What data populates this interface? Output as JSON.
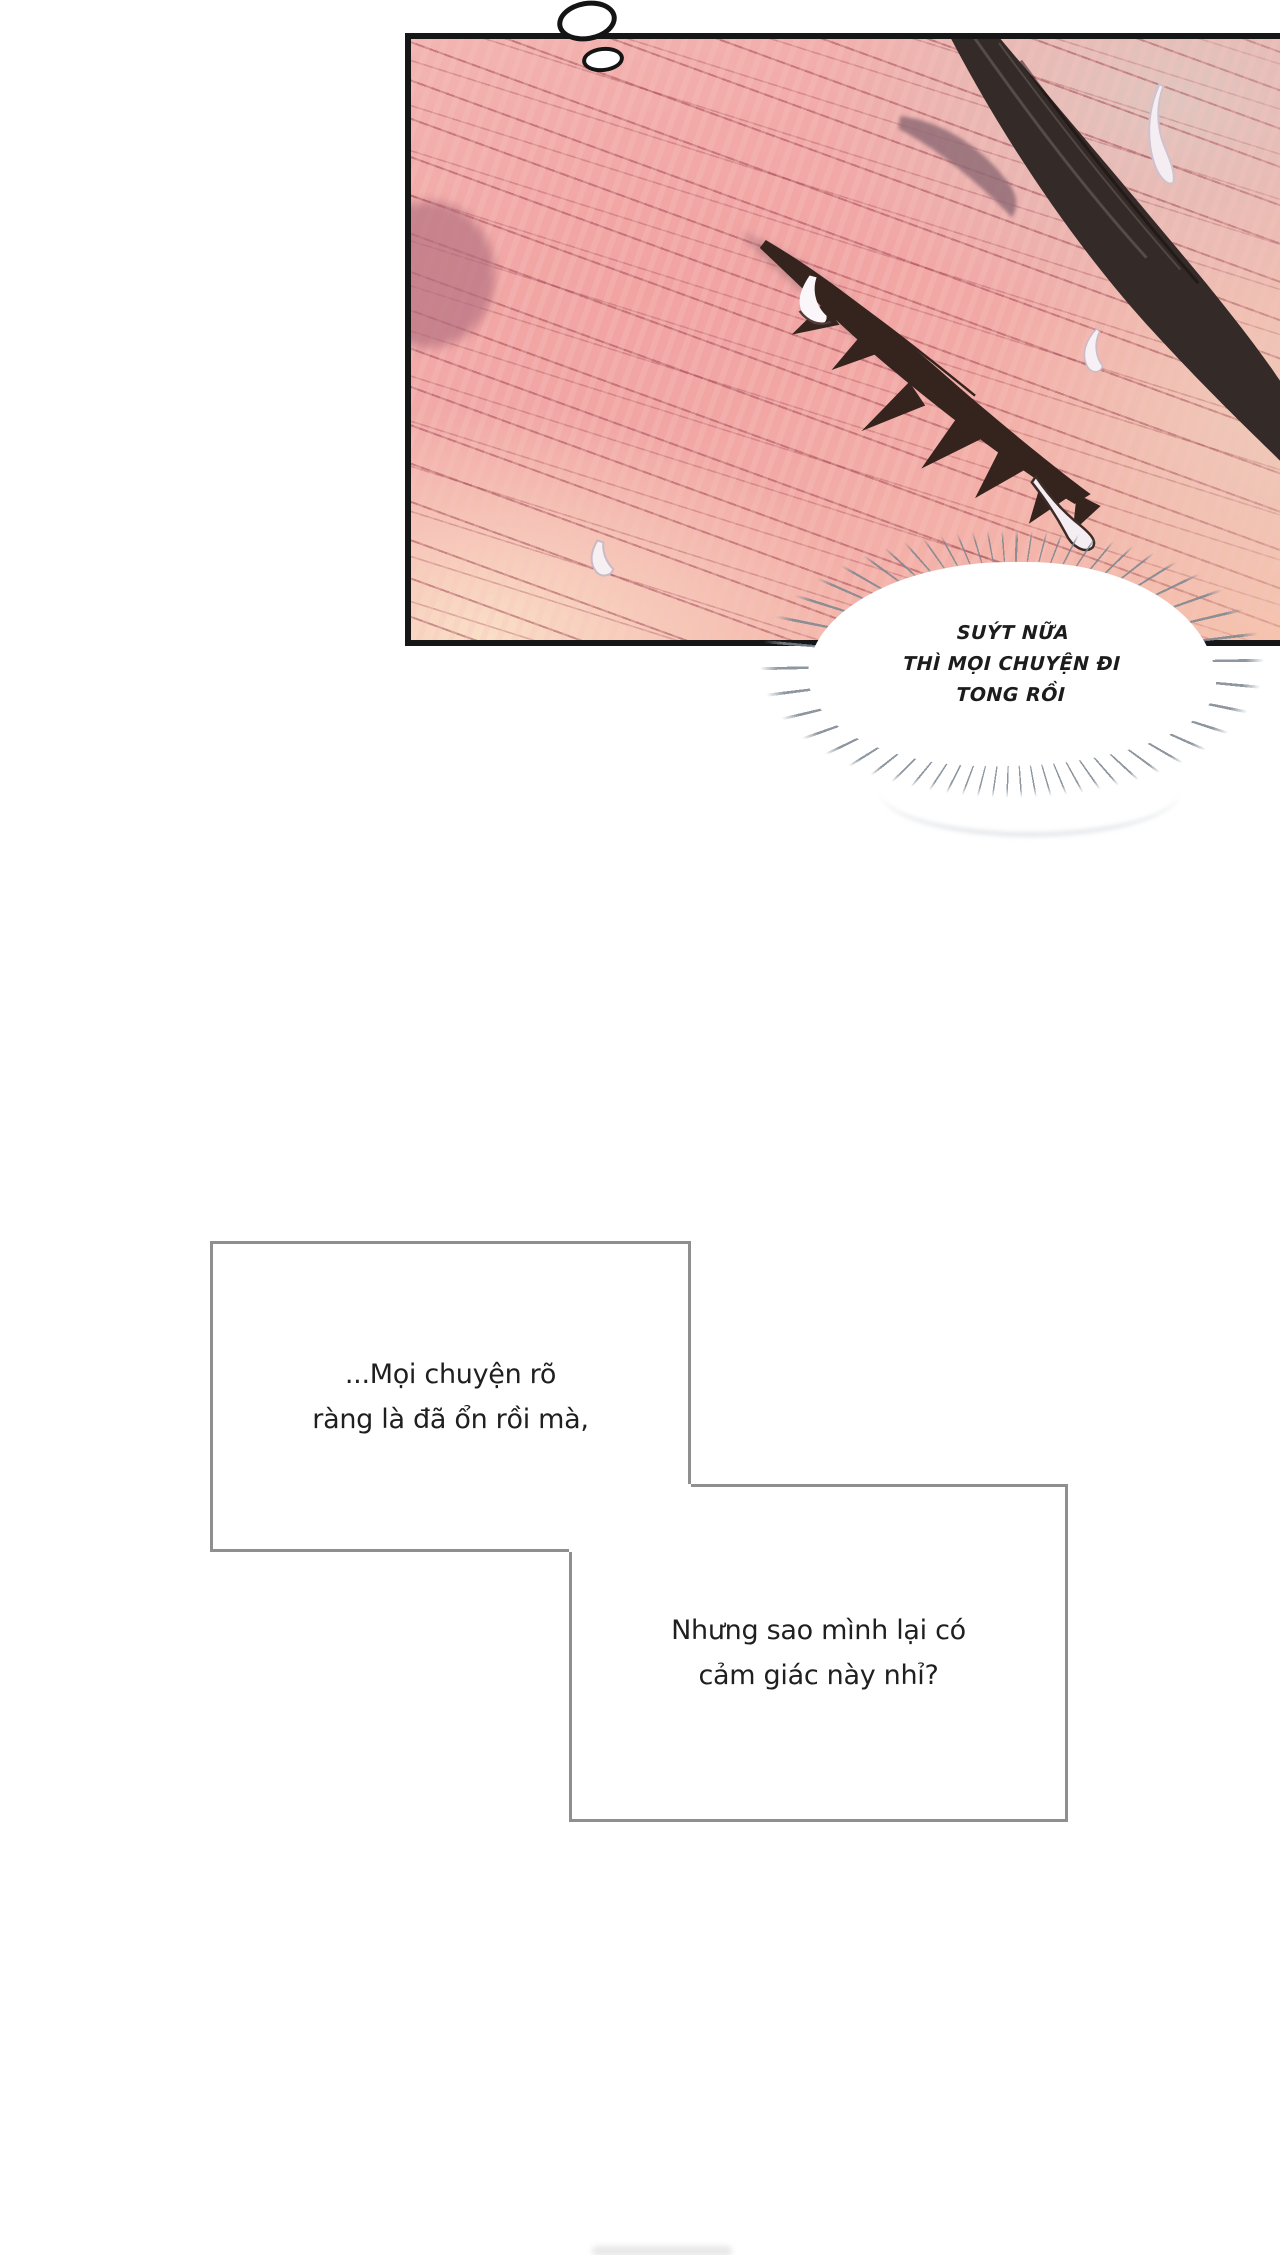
{
  "panel": {
    "border_color": "#161616",
    "skin_colors": {
      "top_left_pink": "#f4c3bd",
      "center_pink": "#f1a3a2",
      "bottom_left_cream": "#fadfc7",
      "top_right_beige": "#e0c5bf"
    },
    "speedline_color": "#9b424d",
    "blush_color": "#b16e7e",
    "eyebrow_color": "#8f6b75",
    "hair_color": "#342a27",
    "lash_color": "#35231d",
    "tear_fill": "#f4edf2",
    "tear_outline": "#3c2b26",
    "sweat_drop_fill": "#f4eef2",
    "sweat_drop_edge": "#cfc2ce"
  },
  "thought_bubble": {
    "outline_color": "#141414",
    "fill_color": "#ffffff"
  },
  "burst_bubble": {
    "lines": [
      "SUÝT NỮA",
      "THÌ MỌI CHUYỆN ĐI",
      "TONG RỒI"
    ],
    "text_color": "#1c1c1c",
    "cloud_fill": "#ffffff",
    "ray_color": "#7a858f"
  },
  "captions": {
    "border_color": "#8f8f8f",
    "fill_color": "#ffffff",
    "text_color": "#1f1f1f",
    "box1": {
      "lines": [
        "...Mọi chuyện rõ",
        "ràng là đã ổn rồi mà,"
      ]
    },
    "box2": {
      "lines": [
        "Nhưng sao mình lại có",
        "cảm giác này nhỉ?"
      ]
    }
  }
}
